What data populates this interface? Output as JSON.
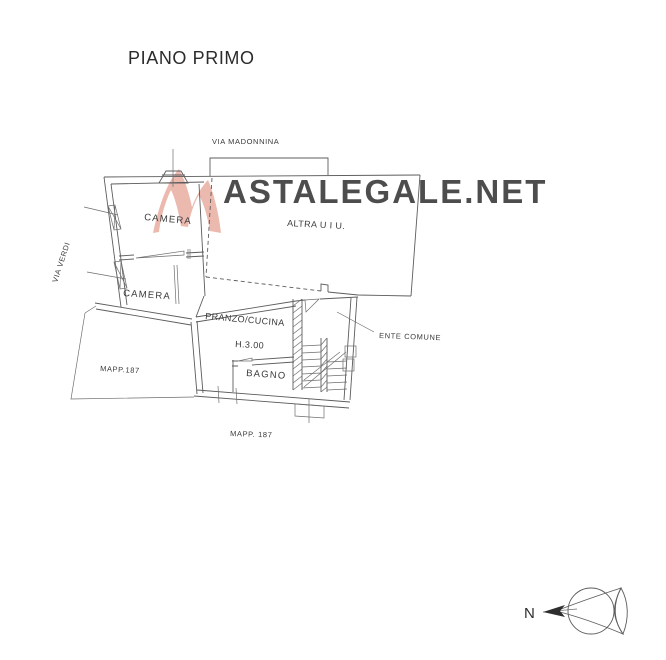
{
  "title": "PIANO PRIMO",
  "plan": {
    "street_top": "VIA MADONNINA",
    "street_left": "VIA VERDI",
    "rooms": {
      "camera1": "CAMERA",
      "camera2": "CAMERA",
      "altra_uiu": "ALTRA U I U.",
      "pranzo_cucina": "PRANZO/CUCINA",
      "height_note": "H.3.00",
      "bagno": "BAGNO",
      "ente_comune": "ENTE COMUNE"
    },
    "parcels": {
      "mapp_left": "MAPP.187",
      "mapp_bottom": "MAPP. 187"
    }
  },
  "watermark": {
    "text": "ASTALEGALE.NET",
    "color": "#f2d9d4",
    "logo_color": "#eab2a7"
  },
  "compass": {
    "north_label": "N"
  },
  "colors": {
    "background": "#ffffff",
    "line": "#5c5c5c",
    "text": "#3a3a3a"
  }
}
